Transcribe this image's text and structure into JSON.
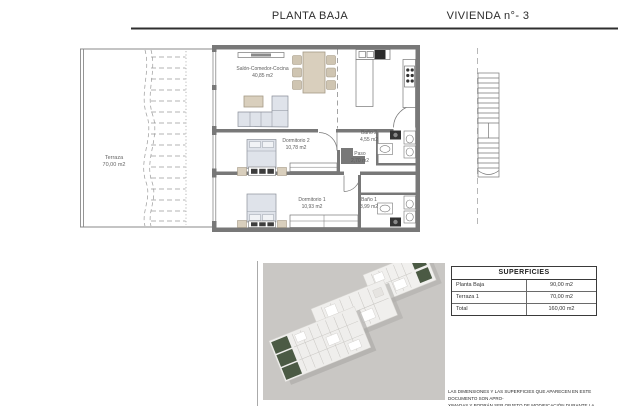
{
  "header": {
    "left_title": "PLANTA BAJA",
    "right_title": "VIVIENDA n°- 3"
  },
  "plan": {
    "rooms": {
      "terraza": {
        "name": "Terraza",
        "area": "70,00 m2"
      },
      "salon": {
        "name": "Salón-Comedor-Cocina",
        "area": "40,85 m2"
      },
      "dormitorio2": {
        "name": "Dormitorio 2",
        "area": "10,78 m2"
      },
      "paso": {
        "name": "Paso",
        "area": "2,70 m2"
      },
      "bano2": {
        "name": "Baño 2",
        "area": "4,55 m2"
      },
      "dormitorio1": {
        "name": "Dormitorio 1",
        "area": "10,93 m2"
      },
      "bano1": {
        "name": "Baño 1",
        "area": "3,99 m2"
      }
    }
  },
  "superficies_table": {
    "title": "SUPERFICIES",
    "rows": [
      {
        "label": "Planta Baja",
        "value": "90,00 m2"
      },
      {
        "label": "Terraza 1",
        "value": "70,00 m2"
      },
      {
        "label": "Total",
        "value": "160,00 m2"
      }
    ]
  },
  "footnote": {
    "line1": "LAS DIMENSIONES Y LAS SUPERFICIES QUE APARECEN EN ESTE DOCUMENTO SON APRO-",
    "line2": "XIMADAS Y PODRÁN SER OBJETO DE MODIFICACIÓN DURANTE LA REDACCIÓN DE LOS"
  },
  "colors": {
    "wall_gray": "#787878",
    "line_gray": "#777777",
    "bed_fill": "#dfe3ea",
    "wood_fill": "#d9cfbd",
    "appliance_dark": "#2b2b2b",
    "render_background": "#c9c7c4",
    "render_green": "#4b5a44"
  }
}
